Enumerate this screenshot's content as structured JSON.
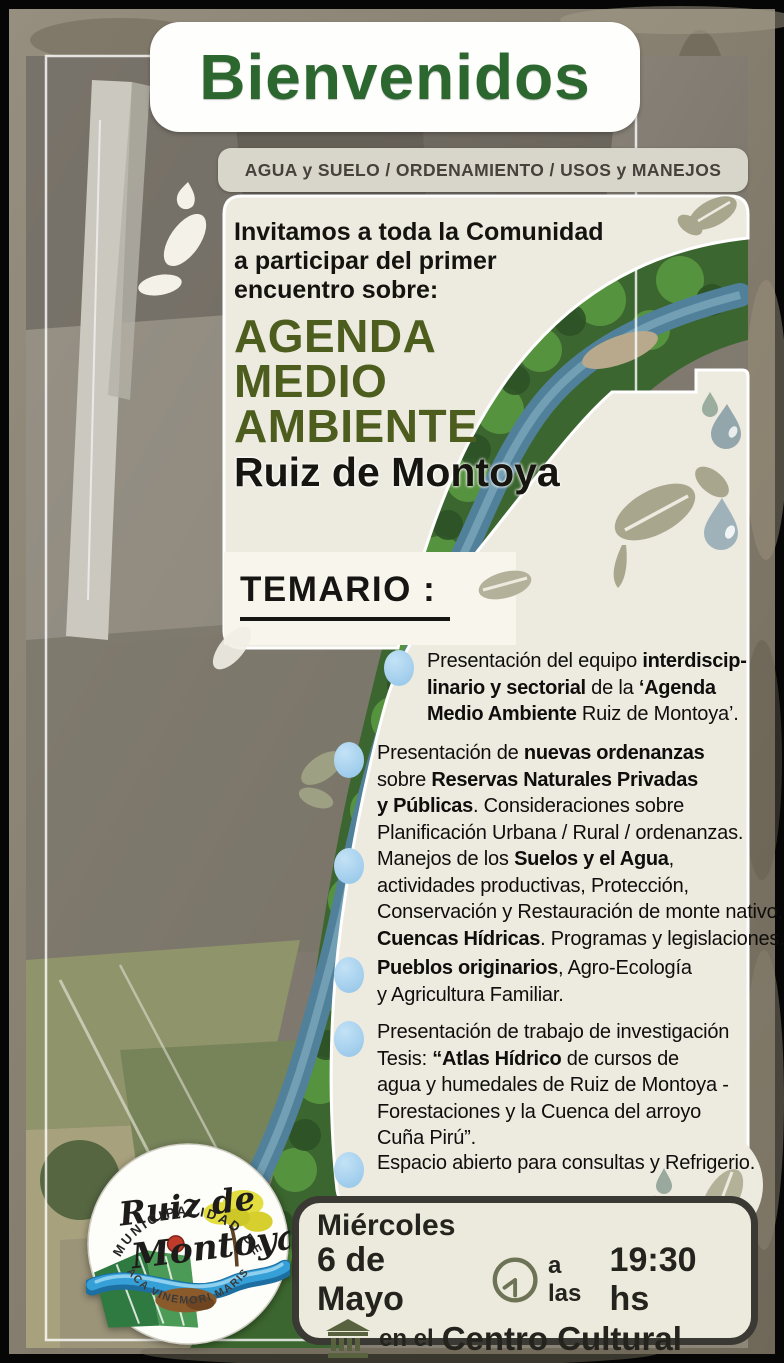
{
  "poster": {
    "title": "Bienvenidos",
    "topics_bar": "AGUA y SUELO / ORDENAMIENTO / USOS y MANEJOS",
    "intro_lines": [
      "Invitamos a toda la Comunidad",
      "a participar del primer",
      "encuentro sobre:"
    ],
    "agenda_title_lines": [
      "AGENDA",
      "MEDIO",
      "AMBIENTE"
    ],
    "agenda_subtitle": "Ruiz de Montoya",
    "temario_heading": "TEMARIO :",
    "temario_items": [
      {
        "lines": [
          [
            {
              "t": "Presentación del equipo ",
              "b": false
            },
            {
              "t": "interdiscip-",
              "b": true
            }
          ],
          [
            {
              "t": "linario y sectorial",
              "b": true
            },
            {
              "t": " de la ",
              "b": false
            },
            {
              "t": "‘Agenda",
              "b": true
            }
          ],
          [
            {
              "t": "Medio Ambiente",
              "b": true
            },
            {
              "t": " Ruiz de Montoya’.",
              "b": false
            }
          ]
        ]
      },
      {
        "lines": [
          [
            {
              "t": "Presentación de ",
              "b": false
            },
            {
              "t": "nuevas ordenanzas",
              "b": true
            }
          ],
          [
            {
              "t": "sobre ",
              "b": false
            },
            {
              "t": "Reservas Naturales Privadas",
              "b": true
            }
          ],
          [
            {
              "t": "y Públicas",
              "b": true
            },
            {
              "t": ". Consideraciones sobre",
              "b": false
            }
          ],
          [
            {
              "t": "Planificación Urbana / Rural / ordenanzas.",
              "b": false
            }
          ]
        ]
      },
      {
        "lines": [
          [
            {
              "t": "Manejos de los ",
              "b": false
            },
            {
              "t": "Suelos y el Agua",
              "b": true
            },
            {
              "t": ",",
              "b": false
            }
          ],
          [
            {
              "t": "actividades productivas, Protección,",
              "b": false
            }
          ],
          [
            {
              "t": "Conservación y Restauración de monte nativo,",
              "b": false
            }
          ],
          [
            {
              "t": "Cuencas Hídricas",
              "b": true
            },
            {
              "t": ". Programas y legislaciones.",
              "b": false
            }
          ]
        ]
      },
      {
        "lines": [
          [
            {
              "t": "Pueblos originarios",
              "b": true
            },
            {
              "t": ", Agro-Ecología",
              "b": false
            }
          ],
          [
            {
              "t": "y Agricultura Familiar.",
              "b": false
            }
          ]
        ]
      },
      {
        "lines": [
          [
            {
              "t": "Presentación de trabajo de investigación",
              "b": false
            }
          ],
          [
            {
              "t": "Tesis: ",
              "b": false
            },
            {
              "t": "“Atlas Hídrico",
              "b": true
            },
            {
              "t": " de cursos de",
              "b": false
            }
          ],
          [
            {
              "t": "agua y humedales de Ruiz de Montoya -",
              "b": false
            }
          ],
          [
            {
              "t": "Forestaciones y la Cuenca del arroyo",
              "b": false
            }
          ],
          [
            {
              "t": "Cuña Pirú”.",
              "b": false
            }
          ]
        ]
      },
      {
        "lines": [
          [
            {
              "t": "Espacio abierto para consultas y Refrigerio.",
              "b": false
            }
          ]
        ]
      }
    ],
    "event": {
      "day": "Miércoles",
      "date": "6 de Mayo",
      "time_label": "a las",
      "time": "19:30 hs",
      "venue_label": "en el",
      "venue": "Centro Cultural"
    },
    "logo": {
      "arc_top": "MUNICIPALIDAD DE",
      "name_line1": "Ruiz de",
      "name_line2": "Montoya",
      "arc_bottom": "ACA VINEMORI MARIS"
    },
    "icons": {
      "bullet": "water-drop-icon",
      "time": "clock-icon",
      "venue": "building-icon",
      "decor_leaf": "leaf-icon",
      "decor_drop": "water-drop-icon"
    },
    "colors": {
      "title_green": "#2b672f",
      "agenda_olive": "#4c5d1e",
      "bullet_blue": "#a9d4ef",
      "panel_cream": "#edeadf",
      "event_border": "#3a3934",
      "river_blue": "#57869e"
    }
  }
}
